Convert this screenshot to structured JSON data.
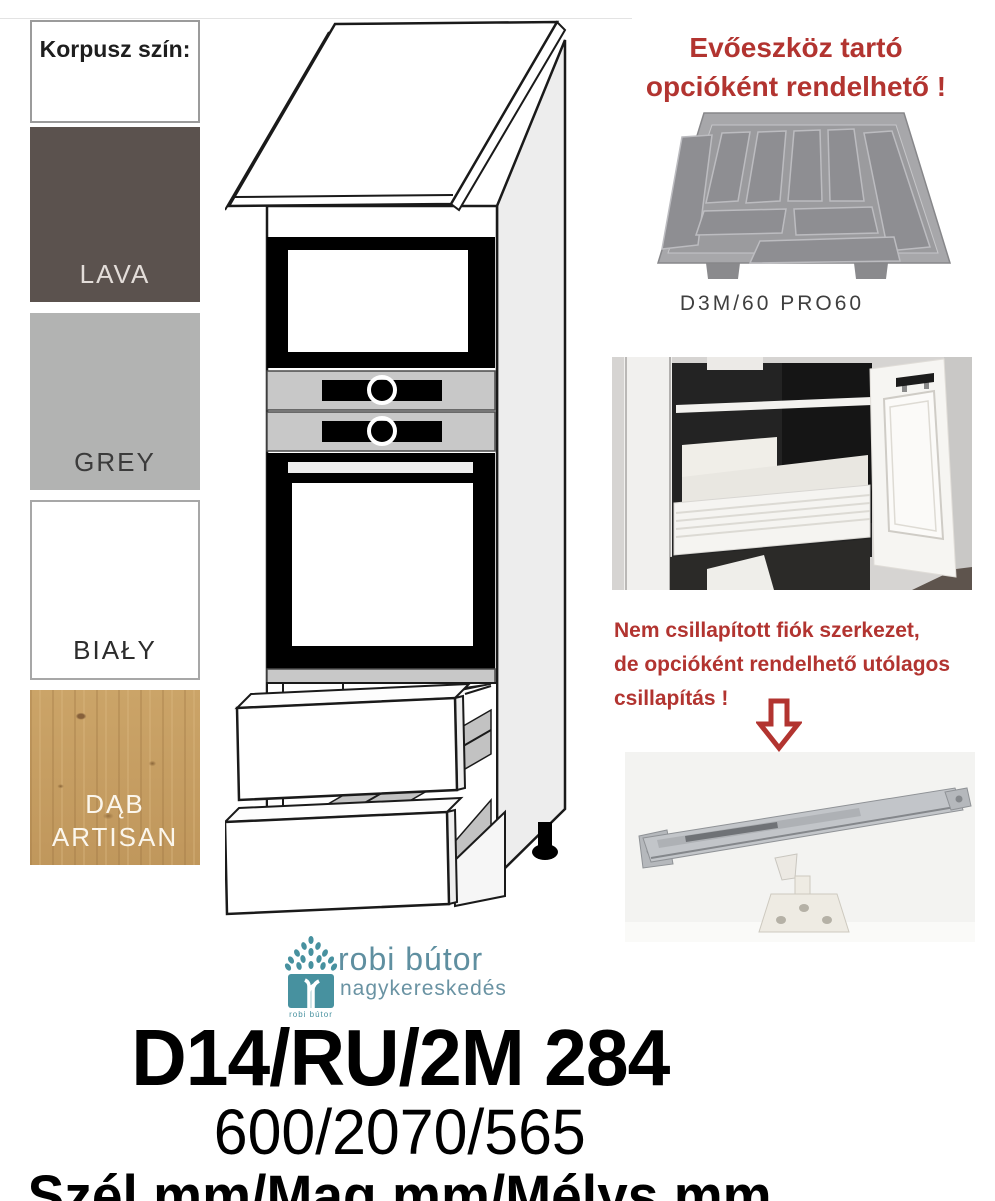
{
  "colors_panel": {
    "header": "Korpusz szín:",
    "swatches": [
      {
        "label": "LAVA",
        "color": "#5b524e",
        "text_color": "#e3ddd9"
      },
      {
        "label": "GREY",
        "color": "#b2b3b2",
        "text_color": "#3b3b3b"
      },
      {
        "label": "BIAŁY",
        "color": "#ffffff",
        "text_color": "#2c2c2c"
      },
      {
        "label": "DĄB ARTISAN",
        "color": "#c79e63",
        "text_color": "#fbf6ec"
      }
    ]
  },
  "cutlery_option": {
    "title_line1": "Evőeszköz tartó",
    "title_line2": "opcióként rendelhető !",
    "caption": "D3M/60 PRO60"
  },
  "damping_note": {
    "line1": "Nem csillapított fiók szerkezet,",
    "line2": "de opcióként rendelhető utólagos",
    "line3": "csillapítás !"
  },
  "logo": {
    "name": "robi bútor",
    "subtitle": "nagykereskedés",
    "icon_caption": "robi bútor"
  },
  "product": {
    "code": "D14/RU/2M 284",
    "dimensions": "600/2070/565",
    "dimensions_label": "Szél.mm/Mag.mm/Mélys.mm"
  },
  "accent_colors": {
    "red": "#b23430",
    "teal": "#47919f"
  }
}
